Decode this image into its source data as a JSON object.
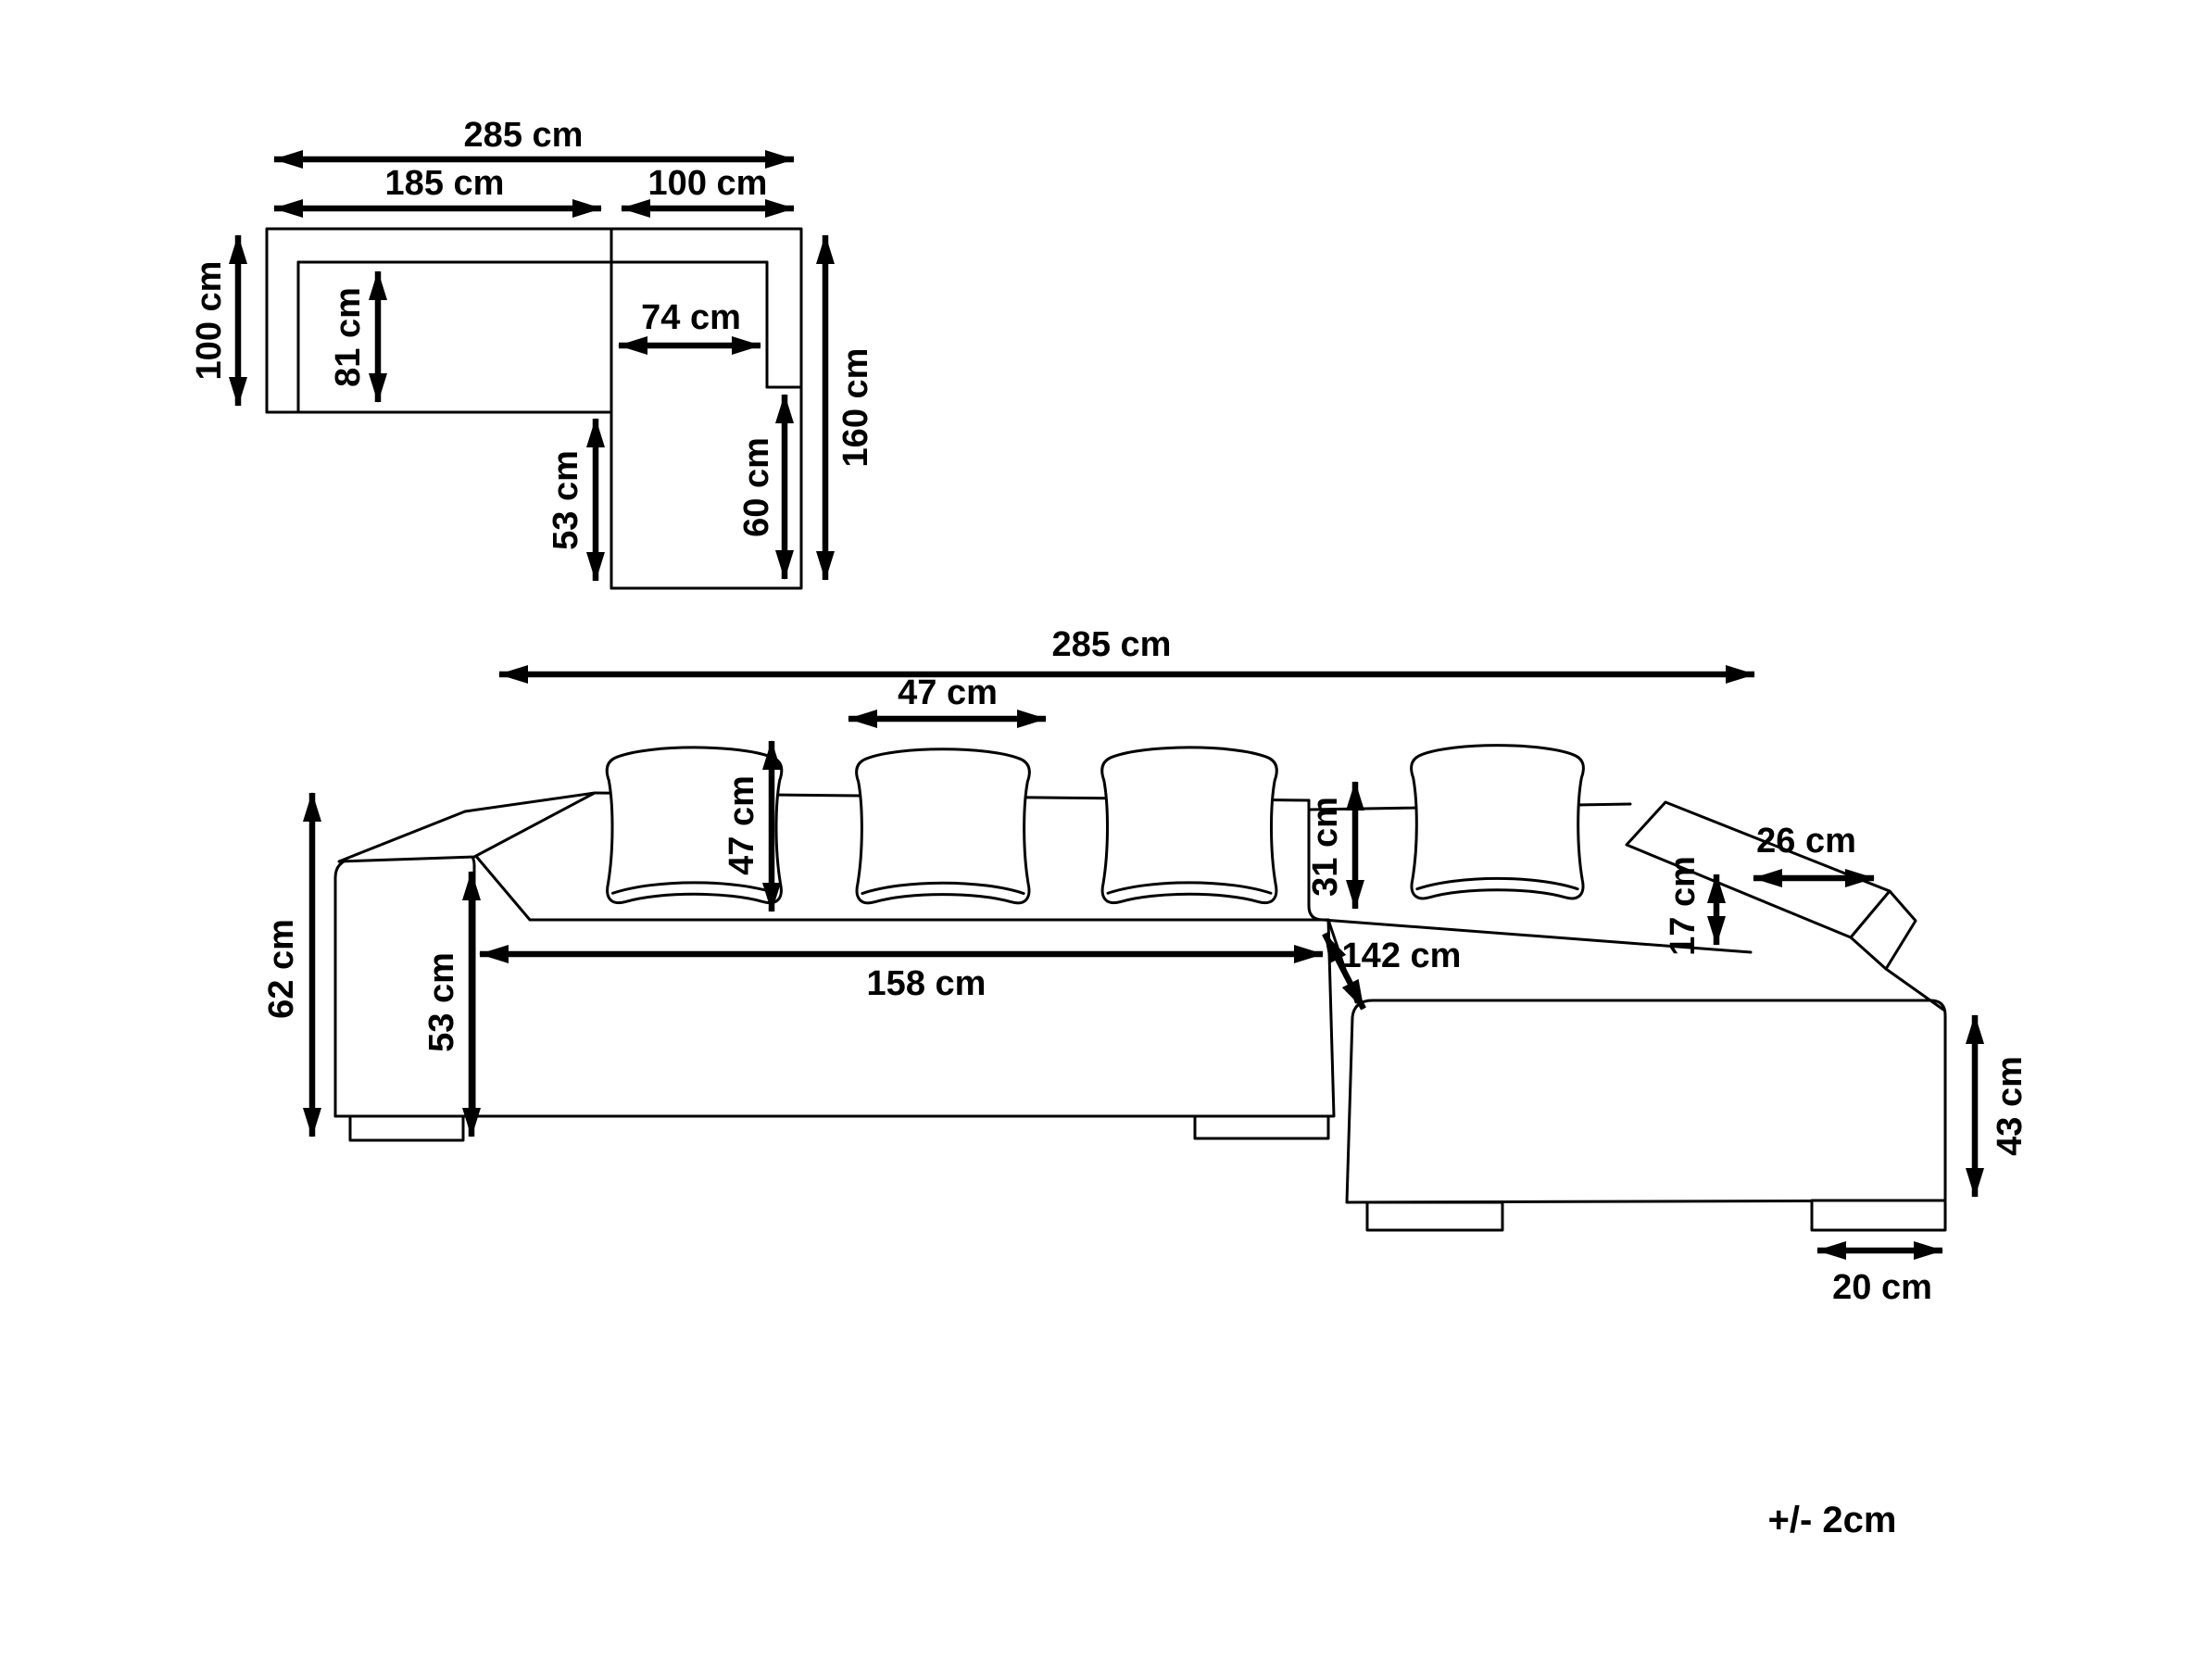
{
  "tolerance_note": "+/- 2cm",
  "plan_view": {
    "labels": {
      "total_width": "285 cm",
      "body_width": "185 cm",
      "section_width": "100 cm",
      "body_depth": "100 cm",
      "seat_depth": "81 cm",
      "corner_seat_width": "74 cm",
      "chaise_extension": "53 cm",
      "chaise_seat_depth": "60 cm",
      "total_depth": "160 cm"
    }
  },
  "front_view": {
    "labels": {
      "total_width": "285 cm",
      "cushion_width": "47 cm",
      "cushion_height": "47 cm",
      "total_height": "62 cm",
      "armrest_height": "53 cm",
      "seat_front_width": "158 cm",
      "chaise_length": "142 cm",
      "backrest_height": "31 cm",
      "right_armrest_width": "26 cm",
      "right_armrest_above_seat": "17 cm",
      "chaise_side_height": "43 cm",
      "foot_width": "20 cm"
    }
  }
}
